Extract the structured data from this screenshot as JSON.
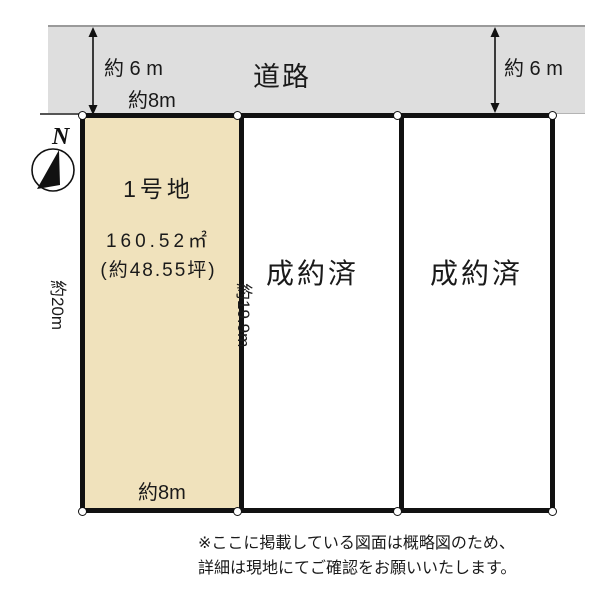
{
  "diagram": {
    "road_label": "道路",
    "road_width_left": "約 6 m",
    "road_width_right": "約 6 m",
    "frontage_top": "約8m",
    "frontage_bottom": "約8m",
    "depth_left": "約20m",
    "depth_middle": "約19.9m",
    "compass": {
      "north_label": "N"
    },
    "plots": [
      {
        "name": "1号地",
        "area_m2": "160.52㎡",
        "area_tsubo": "(約48.55坪)",
        "status": ""
      },
      {
        "name": "",
        "status": "成約済"
      },
      {
        "name": "",
        "status": "成約済"
      }
    ],
    "colors": {
      "road_fill": "#dedede",
      "plot1_fill": "#f0e2bc",
      "border": "#111111",
      "text": "#1a1a1a"
    }
  },
  "footer": {
    "note_line1": "※ここに掲載している図面は概略図のため、",
    "note_line2": "詳細は現地にてご確認をお願いいたします。"
  }
}
